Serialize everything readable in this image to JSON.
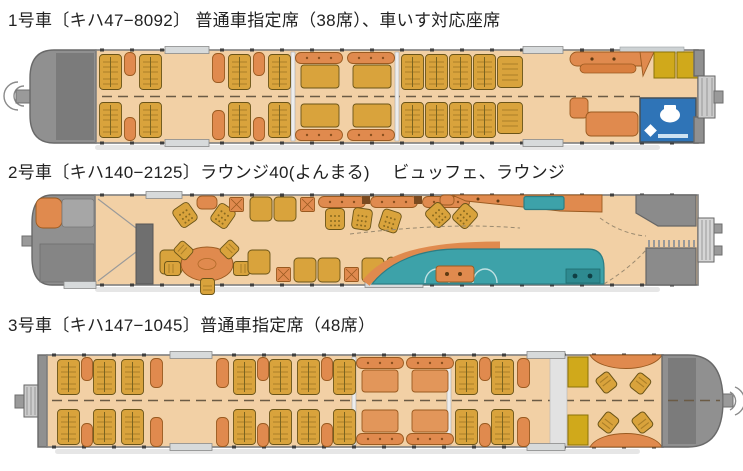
{
  "page": {
    "background": "#ffffff"
  },
  "cars": [
    {
      "id": "car-1",
      "title": "1号車〔キハ47−8092〕 普通車指定席（38席）、車いす対応座席",
      "features": [
        "普通車指定席（38席）",
        "車いす対応座席"
      ]
    },
    {
      "id": "car-2",
      "title": "2号車〔キハ140−2125〕ラウンジ40(よんまる)　 ビュッフェ、ラウンジ",
      "features": [
        "ラウンジ40(よんまる)",
        "ビュッフェ",
        "ラウンジ"
      ]
    },
    {
      "id": "car-3",
      "title": "3号車〔キハ147−1045〕普通車指定席（48席）",
      "features": [
        "普通車指定席（48席）"
      ]
    }
  ],
  "palette": {
    "bg": "#ffffff",
    "floor": "#f2d0a5",
    "gold": "#d9a33c",
    "orange": "#e08a4e",
    "teal": "#3da2a9",
    "blue": "#2f74b7",
    "mustard": "#d0a91b",
    "cab": "#909090"
  }
}
